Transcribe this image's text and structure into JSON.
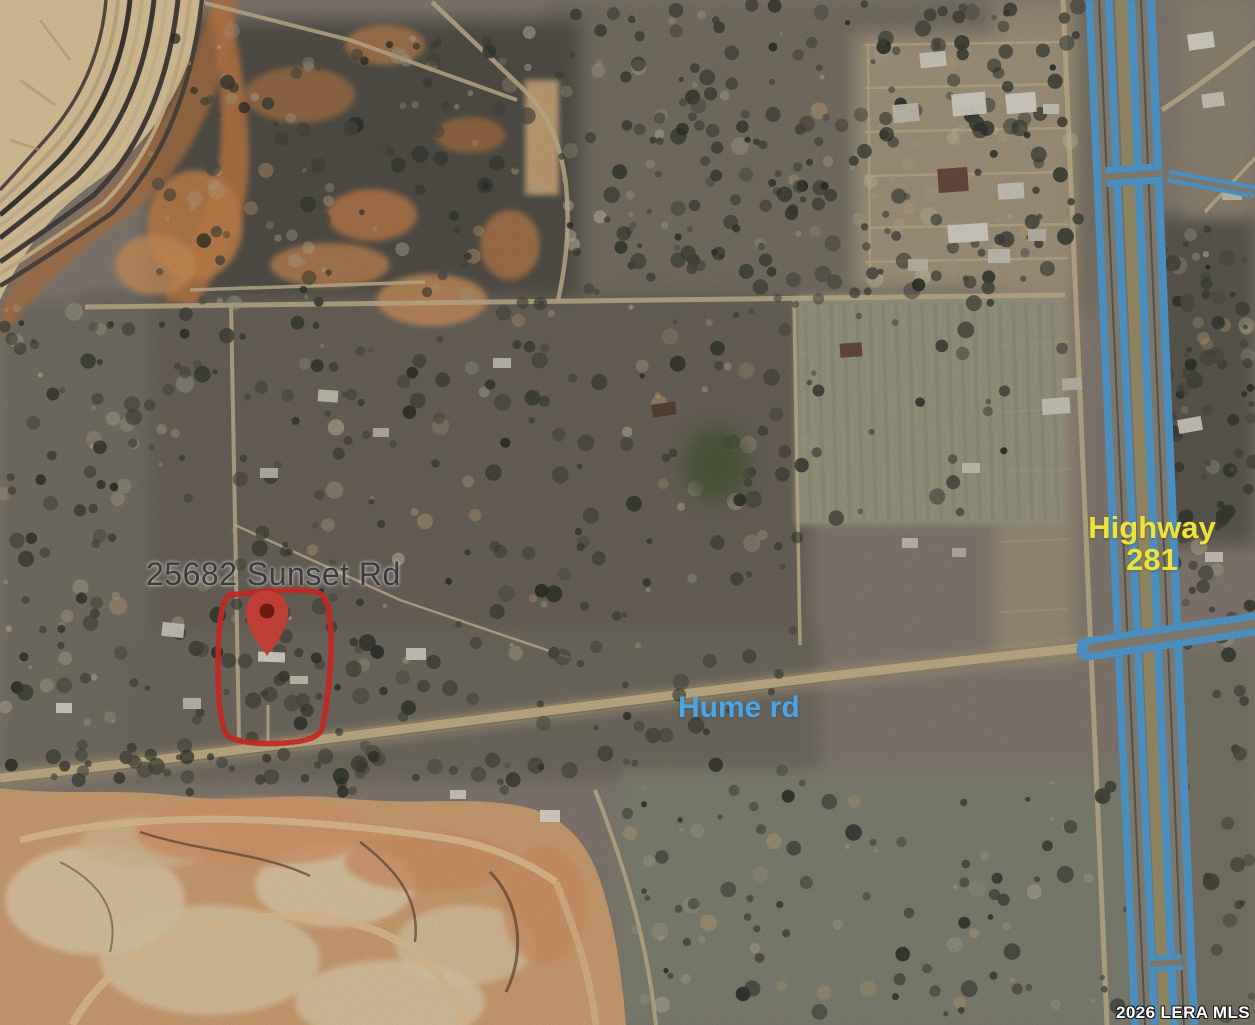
{
  "map": {
    "type": "satellite-aerial-photo",
    "address_label": "25682 Sunset Rd",
    "highway_label": {
      "line1": "Highway",
      "line2": "281"
    },
    "road_label": "Hume rd",
    "watermark": "2026 LERA MLS",
    "marker": {
      "name": "property-location-pin",
      "color": "#db493c",
      "inner_dot_color": "#7c1f16"
    },
    "property_outline_color": "#de2f26",
    "route_highlight_color": "#55a4dc",
    "label_colors": {
      "address": "#3b3b3b",
      "highway": "#f0e23c",
      "road": "#47a6e3",
      "watermark": "#ffffff"
    }
  }
}
